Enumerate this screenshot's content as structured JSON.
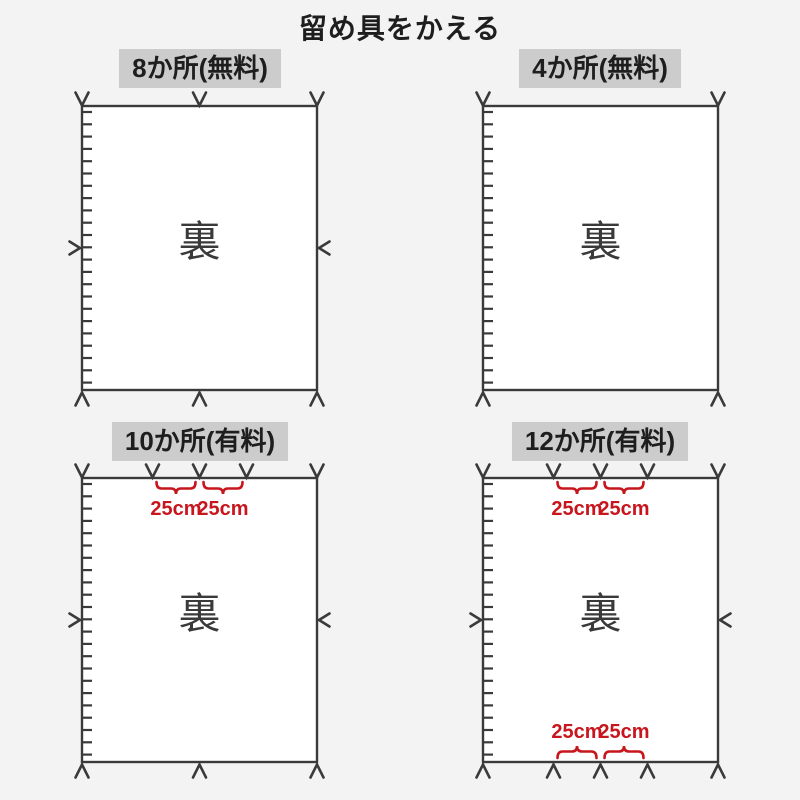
{
  "title": "留め具をかえる",
  "back_label": "裏",
  "spacing_label": "25cm",
  "colors": {
    "background": "#f3f3f3",
    "sheet": "#ffffff",
    "line": "#3a3a3a",
    "badge_bg": "#cccccc",
    "text": "#1e1e1e",
    "accent_red": "#c7161d"
  },
  "panels": [
    {
      "badge": "8か所(無料)",
      "fastener_count": 8,
      "pricing": "無料",
      "top_marks": [
        0,
        0.5,
        1
      ],
      "side_marks": true,
      "bottom_marks": [
        0,
        0.5,
        1
      ],
      "top_spacing": false,
      "bottom_spacing": false
    },
    {
      "badge": "4か所(無料)",
      "fastener_count": 4,
      "pricing": "無料",
      "top_marks": [
        0,
        1
      ],
      "side_marks": false,
      "bottom_marks": [
        0,
        1
      ],
      "top_spacing": false,
      "bottom_spacing": false
    },
    {
      "badge": "10か所(有料)",
      "fastener_count": 10,
      "pricing": "有料",
      "top_marks": [
        0,
        0.3,
        0.5,
        0.7,
        1
      ],
      "side_marks": true,
      "bottom_marks": [
        0,
        0.5,
        1
      ],
      "top_spacing": true,
      "bottom_spacing": false
    },
    {
      "badge": "12か所(有料)",
      "fastener_count": 12,
      "pricing": "有料",
      "top_marks": [
        0,
        0.3,
        0.5,
        0.7,
        1
      ],
      "side_marks": true,
      "bottom_marks": [
        0,
        0.3,
        0.5,
        0.7,
        1
      ],
      "top_spacing": true,
      "bottom_spacing": true
    }
  ]
}
